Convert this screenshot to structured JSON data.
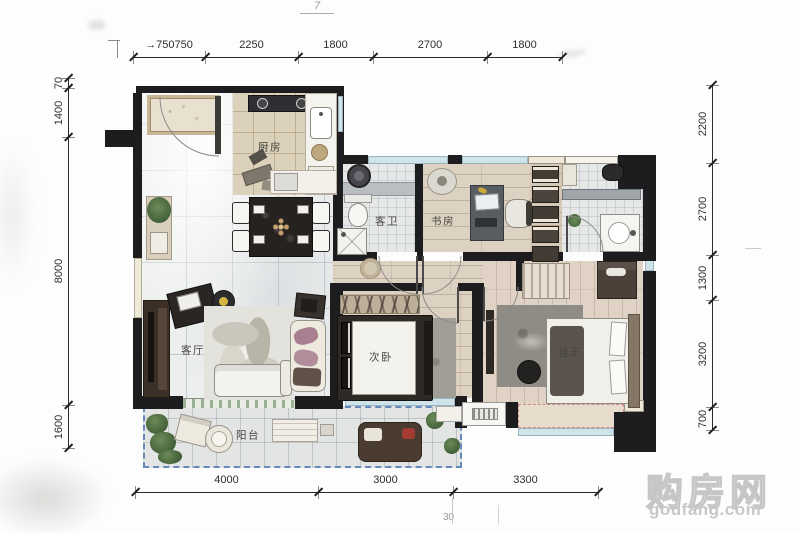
{
  "dims": {
    "top": {
      "orient": "h",
      "line": 57,
      "ticks": [
        133,
        205,
        298,
        373,
        487,
        562
      ],
      "segments": [
        {
          "label": "→750750",
          "from": 133,
          "to": 205
        },
        {
          "label": "2250",
          "from": 205,
          "to": 298
        },
        {
          "label": "1800",
          "from": 298,
          "to": 373
        },
        {
          "label": "2700",
          "from": 373,
          "to": 487
        },
        {
          "label": "1800",
          "from": 487,
          "to": 562
        }
      ]
    },
    "bottom": {
      "orient": "h",
      "line": 492,
      "ticks": [
        135,
        318,
        453,
        598
      ],
      "segments": [
        {
          "label": "4000",
          "from": 135,
          "to": 318
        },
        {
          "label": "3000",
          "from": 318,
          "to": 453
        },
        {
          "label": "3300",
          "from": 453,
          "to": 598
        }
      ]
    },
    "left": {
      "orient": "v",
      "line": 68,
      "ticks": [
        78,
        88,
        137,
        405,
        448
      ],
      "segments": [
        {
          "label": "70",
          "from": 78,
          "to": 88
        },
        {
          "label": "1400",
          "from": 88,
          "to": 137
        },
        {
          "label": "8000",
          "from": 137,
          "to": 405
        },
        {
          "label": "1600",
          "from": 405,
          "to": 448
        }
      ]
    },
    "right": {
      "orient": "v",
      "line": 712,
      "ticks": [
        85,
        163,
        255,
        300,
        407,
        430
      ],
      "segments": [
        {
          "label": "2200",
          "from": 85,
          "to": 163
        },
        {
          "label": "2700",
          "from": 163,
          "to": 255
        },
        {
          "label": "1300",
          "from": 255,
          "to": 300
        },
        {
          "label": "3200",
          "from": 300,
          "to": 407
        },
        {
          "label": "700",
          "from": 407,
          "to": 430
        }
      ]
    }
  },
  "rooms": [
    {
      "id": "kitchen",
      "label": "厨房"
    },
    {
      "id": "guest-bath",
      "label": "客卫"
    },
    {
      "id": "study",
      "label": "书房"
    },
    {
      "id": "living",
      "label": "客厅"
    },
    {
      "id": "second-bedroom",
      "label": "次卧"
    },
    {
      "id": "master-bedroom",
      "label": "主卧"
    },
    {
      "id": "balcony",
      "label": "阳台"
    }
  ],
  "watermark": {
    "name": "购房网",
    "site": "goufang.com"
  },
  "artifacts": {
    "seven": "7",
    "thirty": "30"
  },
  "colors": {
    "wall": "#1d1d1f",
    "window_glass": "#cfe3ea",
    "balcony_outline": "#6688bb",
    "bay_outline": "#cc8888",
    "watermark_gray": "#c8c8c8"
  }
}
